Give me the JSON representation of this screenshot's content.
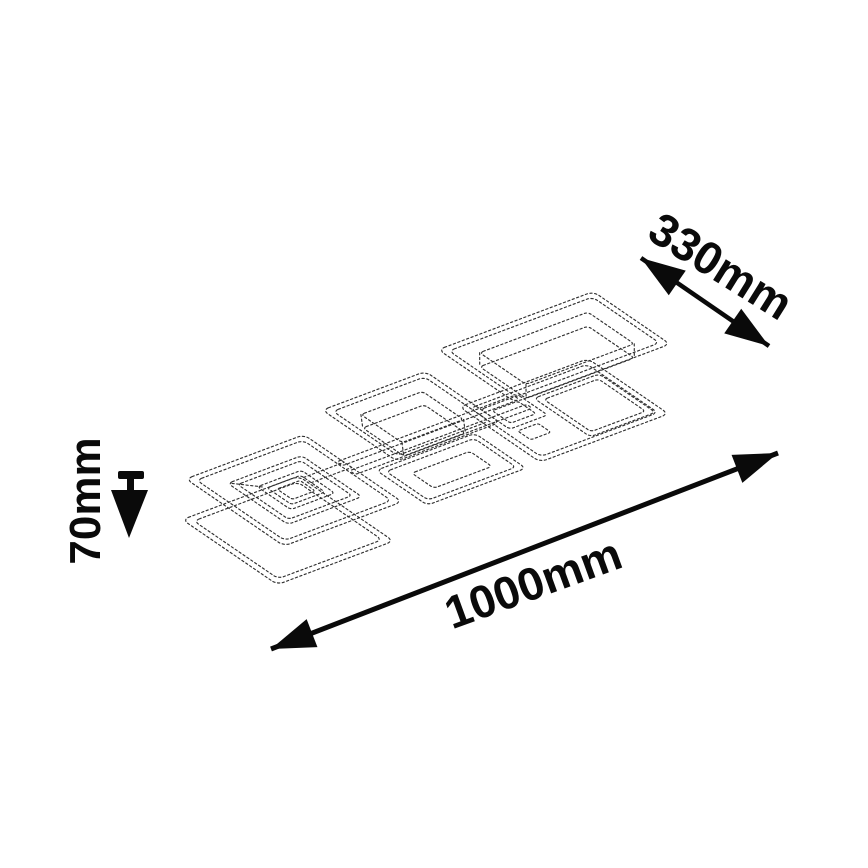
{
  "diagram": {
    "labels": {
      "width": "330mm",
      "height": "70mm",
      "length": "1000mm"
    },
    "icons": {
      "width_arrow": "double-headed-diagonal-arrow",
      "length_arrow": "double-headed-diagonal-arrow",
      "height_marker": "down-arrow-with-tick"
    },
    "colors": {
      "background": "#ffffff",
      "dimension_ink": "#0a0a0a",
      "sketch_ink": "#303030"
    }
  }
}
